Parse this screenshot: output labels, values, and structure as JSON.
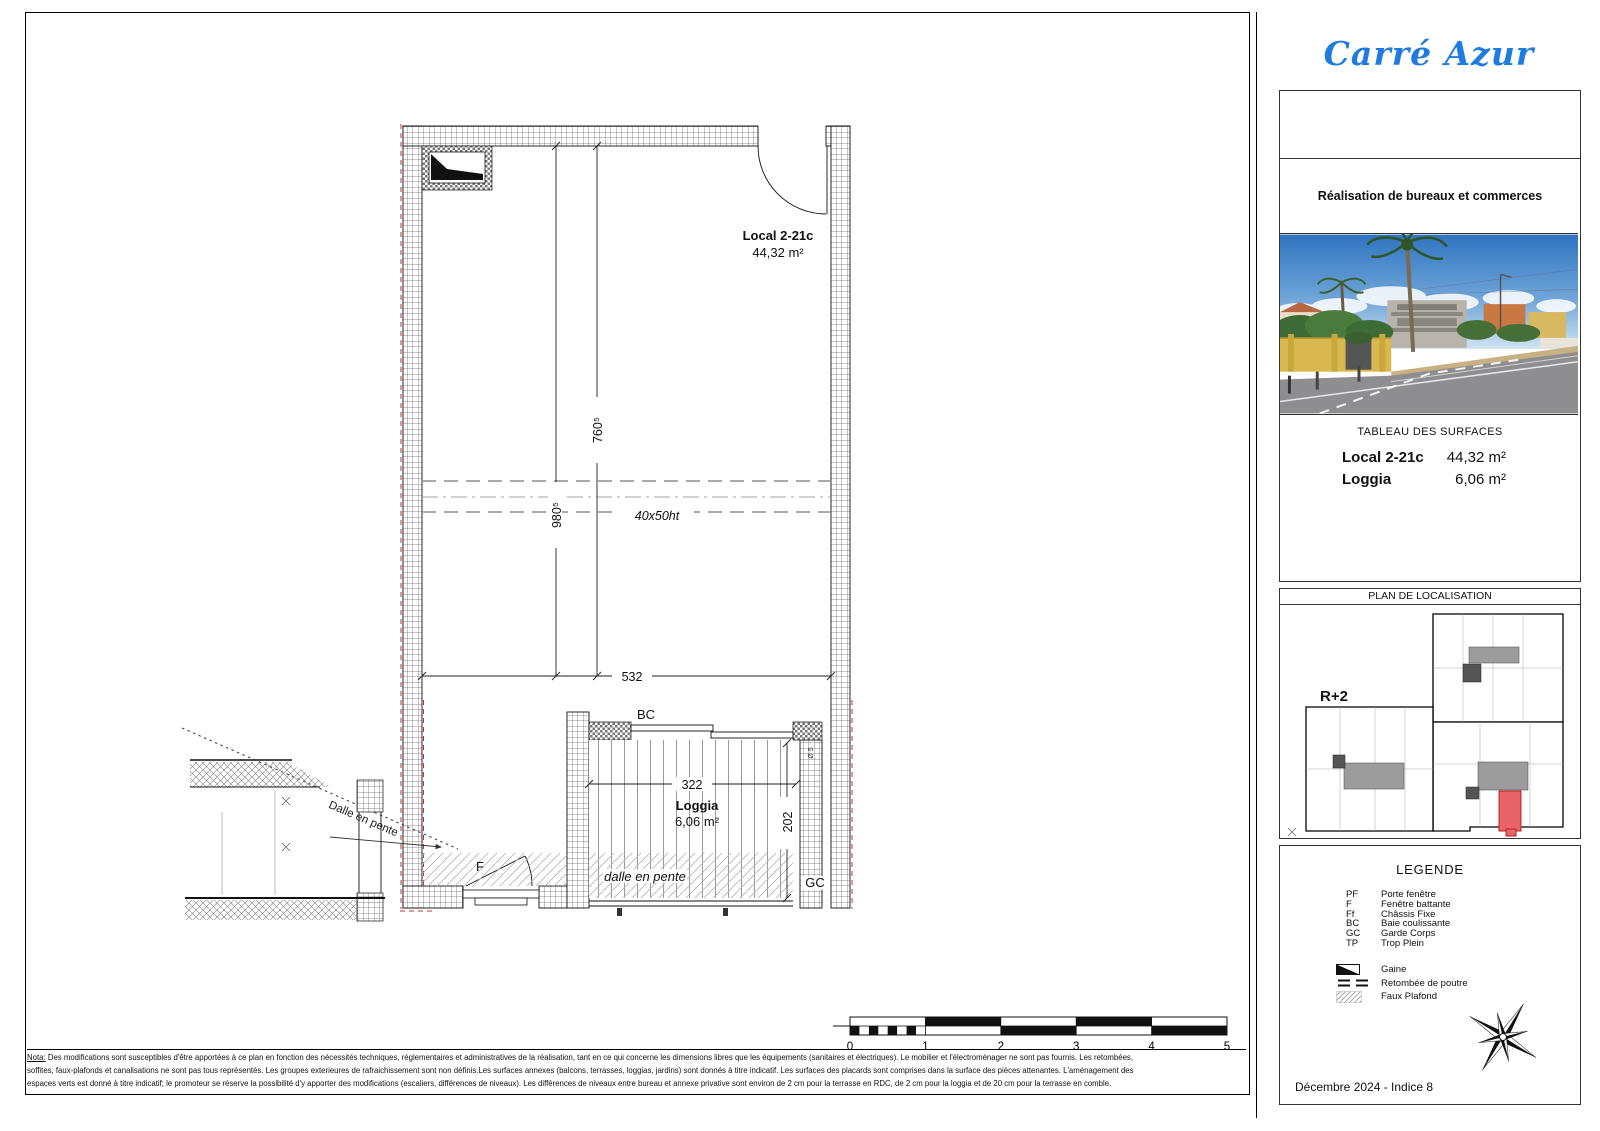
{
  "branding": {
    "logo_text": "Carré Azur",
    "logo_color": "#1e7ce0",
    "tagline": "Réalisation de bureaux et commerces"
  },
  "surfaces": {
    "title": "TABLEAU DES SURFACES",
    "rows": [
      {
        "label": "Local 2-21c",
        "value": "44,32 m²"
      },
      {
        "label": "Loggia",
        "value": "6,06 m²"
      }
    ]
  },
  "localisation": {
    "title": "PLAN DE LOCALISATION",
    "floor_label": "R+2",
    "highlight_color": "#e8636a"
  },
  "legend": {
    "title": "LEGENDE",
    "abbreviations": [
      {
        "abbr": "PF",
        "label": "Porte fenêtre"
      },
      {
        "abbr": "F",
        "label": "Fenêtre battante"
      },
      {
        "abbr": "Ff",
        "label": "Châssis Fixe"
      },
      {
        "abbr": "BC",
        "label": "Baie coulissante"
      },
      {
        "abbr": "GC",
        "label": "Garde Corps"
      },
      {
        "abbr": "TP",
        "label": "Trop Plein"
      }
    ],
    "symbols": [
      {
        "icon": "gaine-symbol",
        "label": "Gaine"
      },
      {
        "icon": "beam-drop-symbol",
        "label": "Retombée de poutre"
      },
      {
        "icon": "false-ceiling-symbol",
        "label": "Faux Plafond"
      }
    ]
  },
  "issue": {
    "date_line": "Décembre 2024 - Indice 8"
  },
  "plan": {
    "unit_name": "Local 2-21c",
    "unit_area": "44,32 m²",
    "loggia_name": "Loggia",
    "loggia_area": "6,06 m²",
    "labels": {
      "bc": "BC",
      "gc": "GC",
      "f": "F",
      "dalle": "dalle en pente",
      "dalle_detail": "Dalle en pente",
      "beam": "40x50ht",
      "loggia_note": "Ø 5"
    },
    "dims": {
      "d760": "760⁵",
      "d980": "980⁵",
      "d532": "532",
      "d322": "322",
      "d202": "202"
    }
  },
  "scale_bar": {
    "ticks": [
      "0",
      "1",
      "2",
      "3",
      "4",
      "5"
    ]
  },
  "notes": {
    "label": "Nota:",
    "line1": "Des modifications sont susceptibles d'être apportées à ce plan en fonction des nécessités techniques, réglementaires et administratives de la réalisation, tant en ce qui concerne les dimensions libres que les équipements (sanitaires et électriques). Le mobilier et l'électroménager ne sont pas fournis. Les retombées,",
    "line2": "soffites, faux-plafonds et canalisations ne sont pas tous représentés. Les groupes exterieures de rafraichissement sont non définis.Les surfaces annexes (balcons, terrasses, loggias, jardins) sont donnés à titre indicatif. Les surfaces des placards sont comprises dans la surface des pièces attenantes. L'aménagement des",
    "line3": "espaces verts est donné à titre indicatif; le promoteur se réserve la possibilité d'y apporter des modifications (escaliers, différences de niveaux). Les différences de niveaux entre bureau et annexe privative sont environ de 2 cm pour la terrasse en RDC, de 2 cm pour la loggia et de 20 cm pour la terrasse en comble."
  }
}
